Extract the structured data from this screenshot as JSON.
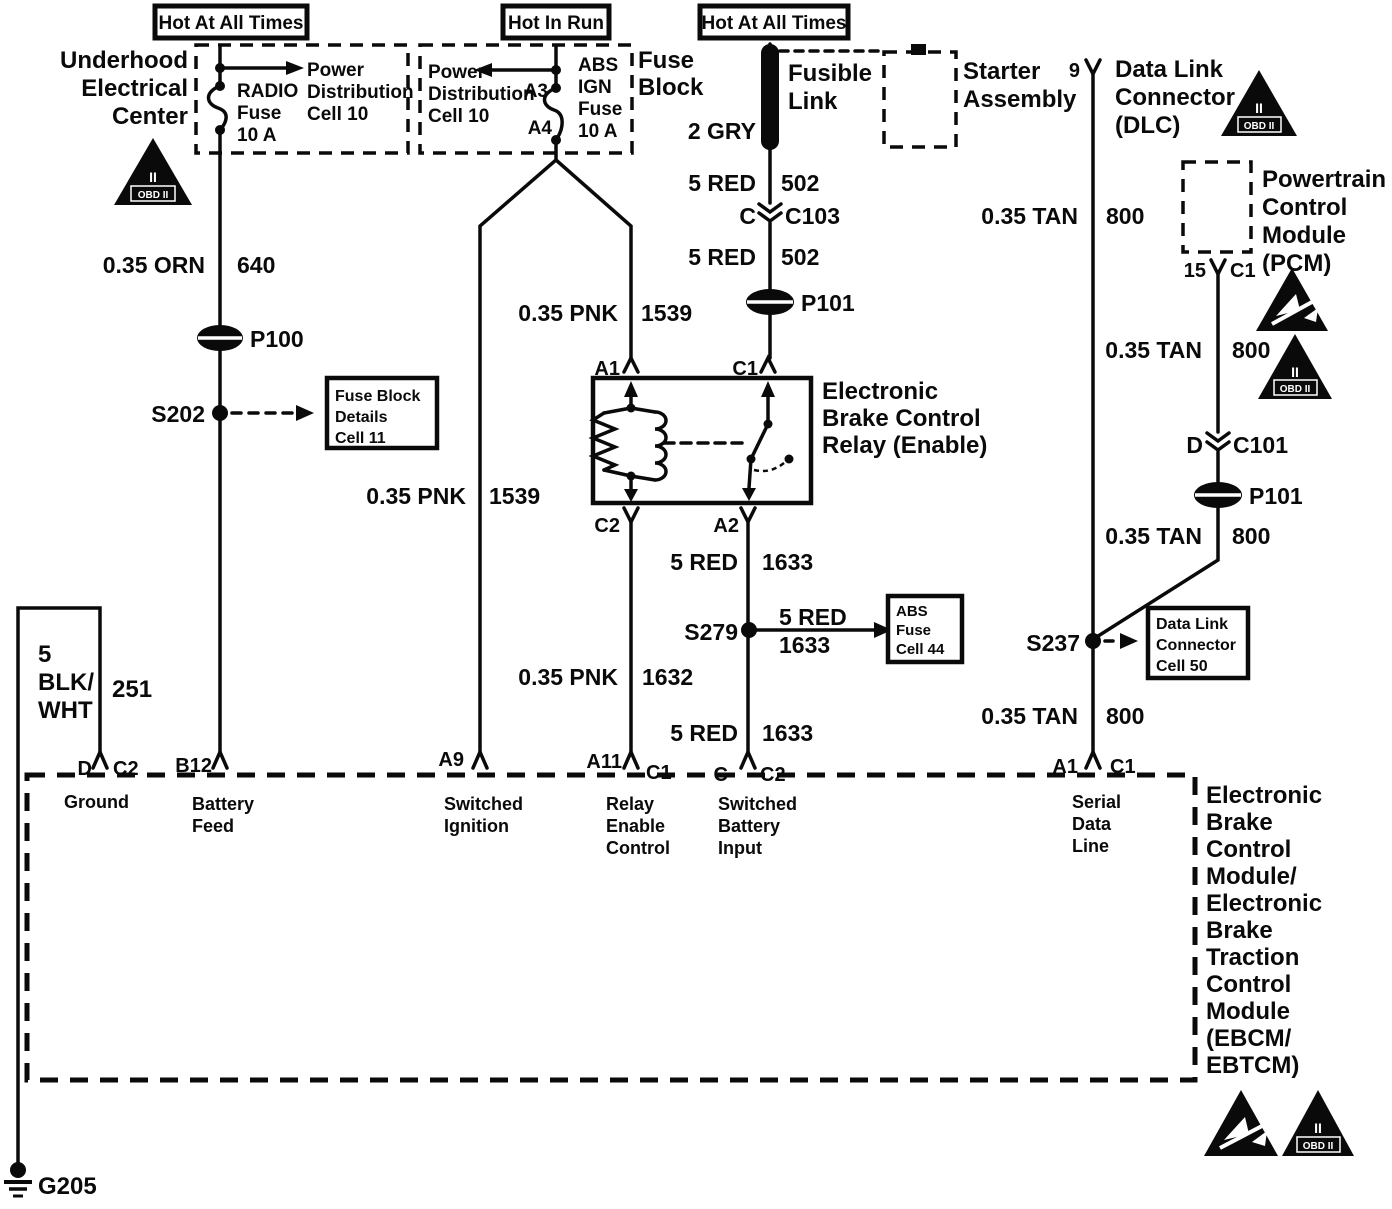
{
  "banners": [
    "Hot At All Times",
    "Hot In Run",
    "Hot At All Times"
  ],
  "underhood": {
    "title": [
      "Underhood",
      "Electrical",
      "Center"
    ],
    "fuse": [
      "RADIO",
      "Fuse",
      "10 A"
    ],
    "dist": [
      "Power",
      "Distribution",
      "Cell 10"
    ]
  },
  "fuse_block": {
    "dist": [
      "Power",
      "Distribution",
      "Cell 10"
    ],
    "pin_a3": "A3",
    "pin_a4": "A4",
    "fuse": [
      "ABS",
      "IGN",
      "Fuse",
      "10 A"
    ],
    "label": [
      "Fuse",
      "Block"
    ]
  },
  "fusible_link": {
    "label": [
      "Fusible",
      "Link"
    ],
    "wire": "2 GRY"
  },
  "starter": [
    "Starter",
    "Assembly"
  ],
  "dlc": {
    "pin": "9",
    "label": [
      "Data Link",
      "Connector",
      "(DLC)"
    ]
  },
  "pcm": {
    "pin": "15",
    "pin2": "C1",
    "label": [
      "Powertrain",
      "Control",
      "Module",
      "(PCM)"
    ]
  },
  "relay": {
    "label": [
      "Electronic",
      "Brake Control",
      "Relay (Enable)"
    ],
    "pin_a1": "A1",
    "pin_c1": "C1",
    "pin_c2": "C2",
    "pin_a2": "A2"
  },
  "ebcm": {
    "label": [
      "Electronic",
      "Brake",
      "Control",
      "Module/",
      "Electronic",
      "Brake",
      "Traction",
      "Control",
      "Module",
      "(EBCM/",
      "EBTCM)"
    ],
    "pins": [
      {
        "l": "D",
        "r": "C2",
        "fn": [
          "Ground"
        ]
      },
      {
        "l": "B12",
        "r": "",
        "fn": [
          "Battery",
          "Feed"
        ]
      },
      {
        "l": "A9",
        "r": "",
        "fn": [
          "Switched",
          "Ignition"
        ]
      },
      {
        "l": "A11",
        "r": "C1",
        "fn": [
          "Relay",
          "Enable",
          "Control"
        ]
      },
      {
        "l": "C",
        "r": "C2",
        "fn": [
          "Switched",
          "Battery",
          "Input"
        ]
      },
      {
        "l": "A1",
        "r": "C1",
        "fn": [
          "Serial",
          "Data",
          "Line"
        ]
      }
    ]
  },
  "wire_labels": [
    {
      "g": "0.35 ORN",
      "n": "640"
    },
    {
      "g": "0.35 PNK",
      "n": "1539"
    },
    {
      "g": "0.35 PNK",
      "n": "1539"
    },
    {
      "g": "5 RED",
      "n": "502"
    },
    {
      "g": "5 RED",
      "n": "502"
    },
    {
      "g": "5 RED",
      "n": "1633"
    },
    {
      "g": "5 RED",
      "n": "1633"
    },
    {
      "g": "0.35 PNK",
      "n": "1632"
    },
    {
      "g": "5 RED",
      "n": "1633"
    },
    {
      "g": "0.35 TAN",
      "n": "800"
    },
    {
      "g": "0.35 TAN",
      "n": "800"
    },
    {
      "g": "0.35 TAN",
      "n": "800"
    },
    {
      "g": "0.35 TAN",
      "n": "800"
    },
    {
      "lines": [
        "5",
        "BLK/",
        "WHT"
      ],
      "n": "251"
    }
  ],
  "components": {
    "p100": "P100",
    "s202": "S202",
    "c103_l": "C",
    "c103_r": "C103",
    "p101a": "P101",
    "s279": "S279",
    "c101_l": "D",
    "c101_r": "C101",
    "p101b": "P101",
    "s237": "S237",
    "g205": "G205"
  },
  "refboxes": {
    "fuse_details": [
      "Fuse Block",
      "Details",
      "Cell 11"
    ],
    "abs_fuse": [
      "ABS",
      "Fuse",
      "Cell 44"
    ],
    "dlc_cell": [
      "Data Link",
      "Connector",
      "Cell 50"
    ]
  },
  "icons": {
    "obd_numeral": "II",
    "obd_box": "OBD II"
  }
}
